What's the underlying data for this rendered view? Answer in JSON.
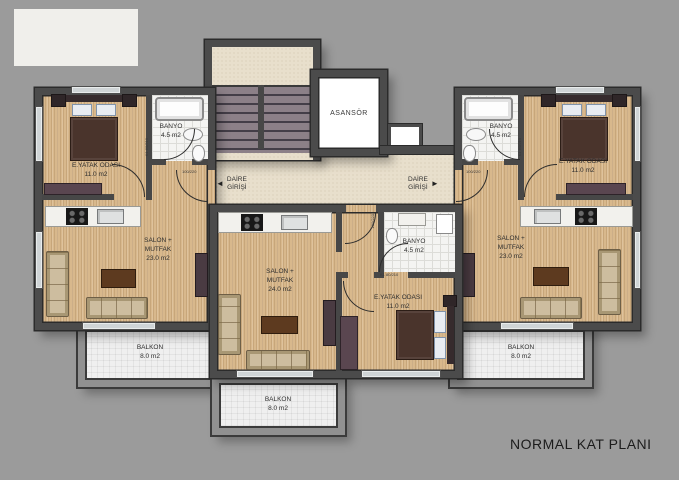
{
  "title": "NORMAL KAT PLANI",
  "core": {
    "elevator_label": "ASANSÖR",
    "entry_left": {
      "line1": "DAİRE",
      "line2": "GİRİŞİ",
      "arrow": "◄"
    },
    "entry_right": {
      "line1": "DAİRE",
      "line2": "GİRİŞİ",
      "arrow": "►"
    }
  },
  "apartments": {
    "left": {
      "bedroom": {
        "name": "E.YATAK ODASI",
        "area": "11.0 m2"
      },
      "bathroom": {
        "name": "BANYO",
        "area": "4.5 m2"
      },
      "living": {
        "name1": "SALON +",
        "name2": "MUTFAK",
        "area": "23.0 m2"
      },
      "balcony": {
        "name": "BALKON",
        "area": "8.0 m2"
      }
    },
    "center": {
      "living": {
        "name1": "SALON +",
        "name2": "MUTFAK",
        "area": "24.0 m2"
      },
      "bathroom": {
        "name": "BANYO",
        "area": "4.5 m2"
      },
      "bedroom": {
        "name": "E.YATAK ODASI",
        "area": "11.0 m2"
      },
      "balcony": {
        "name": "BALKON",
        "area": "8.0 m2"
      }
    },
    "right": {
      "bathroom": {
        "name": "BANYO",
        "area": "4.5 m2"
      },
      "bedroom": {
        "name": "E.YATAK ODASI",
        "area": "11.0 m2"
      },
      "living": {
        "name1": "SALON +",
        "name2": "MUTFAK",
        "area": "23.0 m2"
      },
      "balcony": {
        "name": "BALKON",
        "area": "8.0 m2"
      }
    }
  },
  "door_labels": {
    "left_entry": "100/220",
    "left_rooms": "K1 80/210",
    "right_rooms": "K1 80/210",
    "right_entry": "100/220",
    "center_bath": "K1 80/210",
    "center_entry": "100/220"
  },
  "colors": {
    "background": "#9b9b9b",
    "wall": "#4b4b4b",
    "wood_floor": "#d8b88c",
    "bath_tile": "#f4f4f2",
    "hall_floor": "#e8dfcc",
    "balcony_floor": "#efefef",
    "stair_tread": "#8c8088"
  }
}
